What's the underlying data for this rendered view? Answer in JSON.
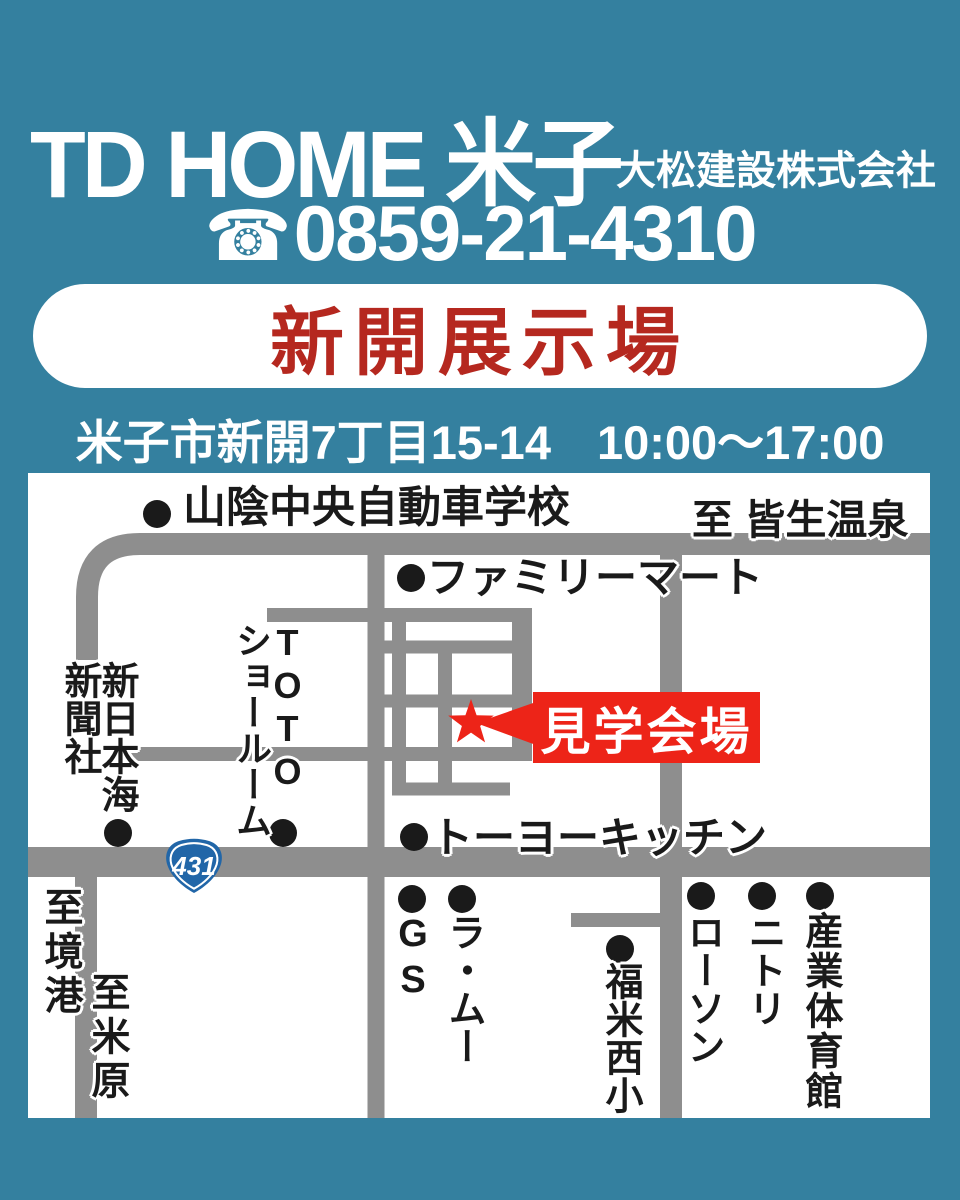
{
  "colors": {
    "bg": "#34809f",
    "road": "#8e8e8e",
    "ink": "#1a1a1a",
    "white": "#ffffff",
    "banner_red": "#b5281f",
    "bright_red": "#ed2418",
    "badge_blue": "#2166a8"
  },
  "header": {
    "title": "TD HOME 米子",
    "company": "大松建設株式会社",
    "phone_icon": "☎",
    "phone": "0859-21-4310",
    "banner": "新開展示場",
    "address": "米子市新開7丁目15-14",
    "hours": "10:00〜17:00"
  },
  "map": {
    "route_badge": "431",
    "venue_label": "見学会場",
    "labels": {
      "driving_school": "山陰中央自動車学校",
      "to_kaike_onsen": "至 皆生温泉",
      "familymart": "ファミリーマート",
      "toto": "TOTO",
      "toto_showroom": "ショールーム",
      "shin_nihonkai": "新日本海",
      "shimbunsha": "新聞社",
      "toyo_kitchen": "トーヨーキッチン",
      "to_sakaiminato": "至境港",
      "to_maibara": "至米原",
      "gs": "GS",
      "lamu": "ラ・ムー",
      "fukuyone_nishi_elementary": "福米西小",
      "lawson": "ローソン",
      "nitori": "ニトリ",
      "sangyo_gymnasium": "産業体育館"
    }
  }
}
